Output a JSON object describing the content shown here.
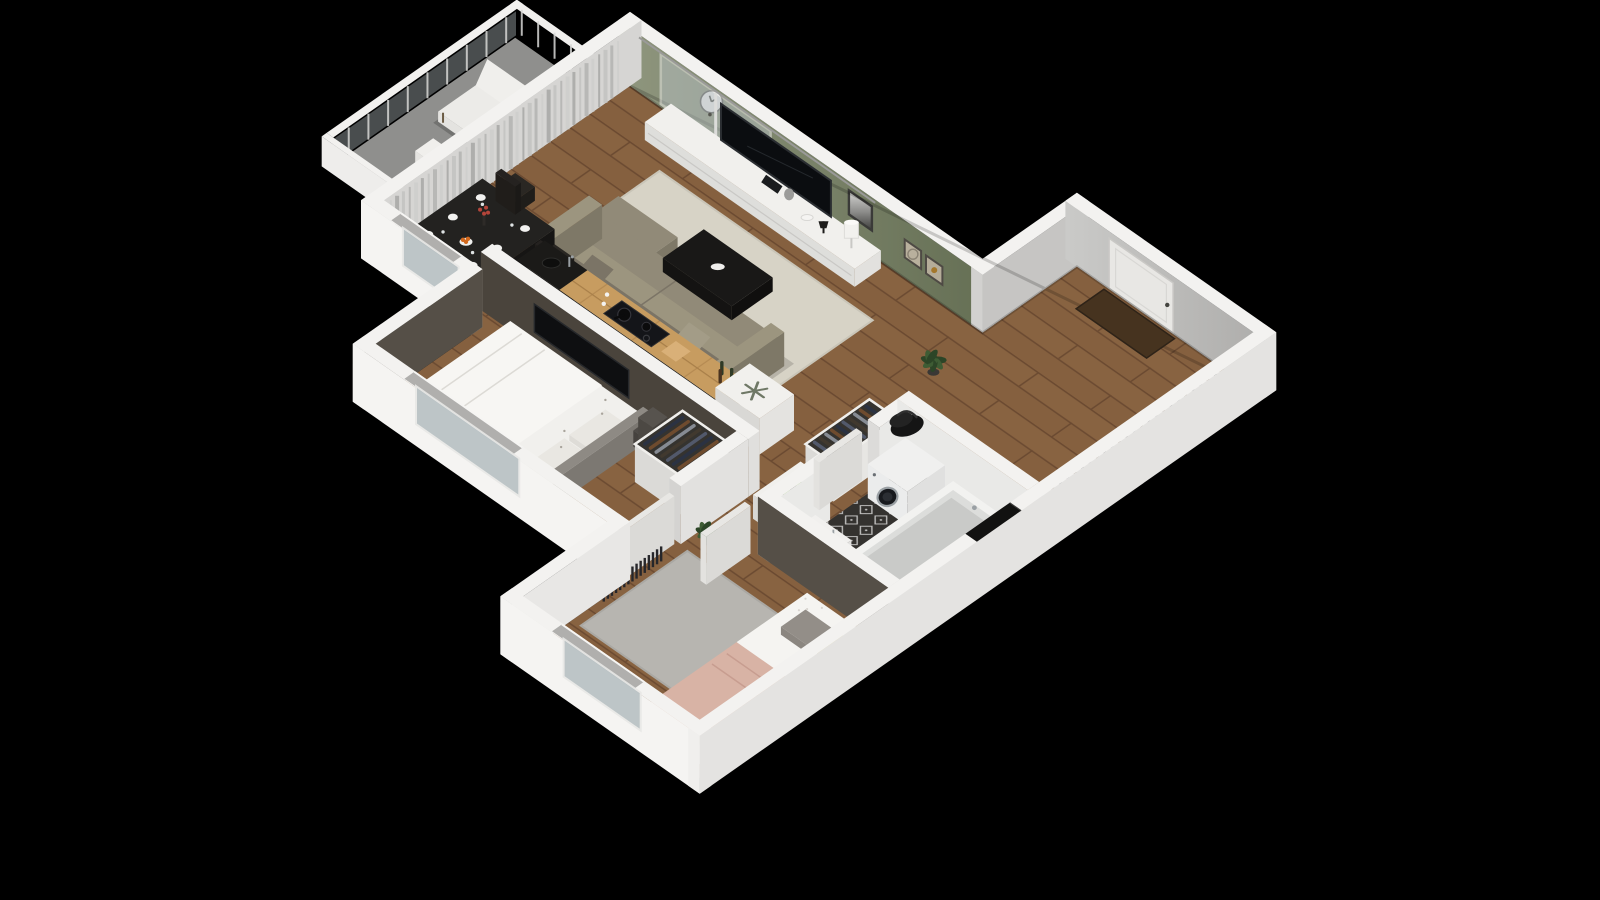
{
  "meta": {
    "title": "Isometric 3D apartment floor plan render",
    "background": "#000000",
    "style": "cutaway isometric"
  },
  "palette": {
    "background": "#000000",
    "wall_top": "#f3f2f0",
    "wall_bright": "#f5f4f2",
    "wall_right": "#e4e3e1",
    "wall_inner": "#d6d5d3",
    "wall_inner_gray": "#c2c1bf",
    "green_wall_light": "#8f967e",
    "green_wall_dark": "#667055",
    "accent_bedroom1": "#4a443c",
    "accent_bedroom2": "#554f47",
    "floor_wood": "#85603f",
    "wood_line": "#6b4a31",
    "aisle_wood": "#bf8f55",
    "kitchen_counter": "#c79c60",
    "counter_line": "#a87f49",
    "black_furniture": "#1e1c1a",
    "tile_floor": "#34322f",
    "tile_mark": "#d9d9d7",
    "tile_wall": "#e9e9e7",
    "rug_living": "#d7d3c6",
    "rug_bedroom2": "#b7b5b0",
    "sofa": "#918a78",
    "sofa_dark": "#7e7867",
    "cushion": "#9c957f",
    "tv_screen": "#0b0d10",
    "white_furniture": "#efeeeb",
    "white_furniture_side": "#dededb",
    "bed_white": "#f1f0ed",
    "blanket_pink": "#d8b3a5",
    "pillow_gray": "#938e88",
    "pillow_yellow": "#d9cf92",
    "glass": "#b7c0c3",
    "curtain": "#c7c7c5",
    "plant_green": "#3e5c34",
    "plant_dark": "#2c4527",
    "pot": "#3a3835",
    "balcony_floor": "#8f8f8d",
    "door": "#e8e7e4",
    "door_mat": "#46331f",
    "washer": "#ebecec",
    "washer_door": "#181a1e",
    "metal": "#9aa0a4",
    "orange_fruit": "#d2691e",
    "flower_red": "#b4453a",
    "book_green": "#7dc242",
    "clothes": [
      "#2b3242",
      "#6e4b2e",
      "#868b93",
      "#41392f",
      "#52596b"
    ],
    "shoes": [
      "#23262e",
      "#5d4328",
      "#7d8288"
    ]
  },
  "icons": {
    "snowflake": "❄"
  },
  "decor": {
    "book_label": "DE"
  },
  "rooms": [
    {
      "id": "living-room",
      "features": [
        "sofa",
        "coffee-table",
        "tv-console",
        "tv",
        "wall-clock",
        "picture-frames",
        "rug",
        "dining-table",
        "dining-chairs"
      ]
    },
    {
      "id": "kitchen",
      "features": [
        "wood-counter",
        "cooktop",
        "black-sink",
        "fridge-with-snowflake"
      ]
    },
    {
      "id": "bedroom-1",
      "features": [
        "double-bed",
        "open-wardrobe",
        "storage-boxes",
        "wall-tv",
        "radiator",
        "window"
      ]
    },
    {
      "id": "bedroom-2",
      "features": [
        "single-bed",
        "rug",
        "plant",
        "radiator",
        "window"
      ]
    },
    {
      "id": "bathroom",
      "features": [
        "washing-machine",
        "bathtub",
        "vanity-sink",
        "toilet",
        "patterned-tile-floor"
      ]
    },
    {
      "id": "hallway",
      "features": [
        "open-closet",
        "dresser",
        "green-book",
        "plants"
      ]
    },
    {
      "id": "entry",
      "features": [
        "front-door",
        "shoe-rack",
        "door-mat",
        "duffel-bag"
      ]
    },
    {
      "id": "balcony",
      "features": [
        "lounge-chair",
        "side-table",
        "glass-railing"
      ]
    }
  ]
}
